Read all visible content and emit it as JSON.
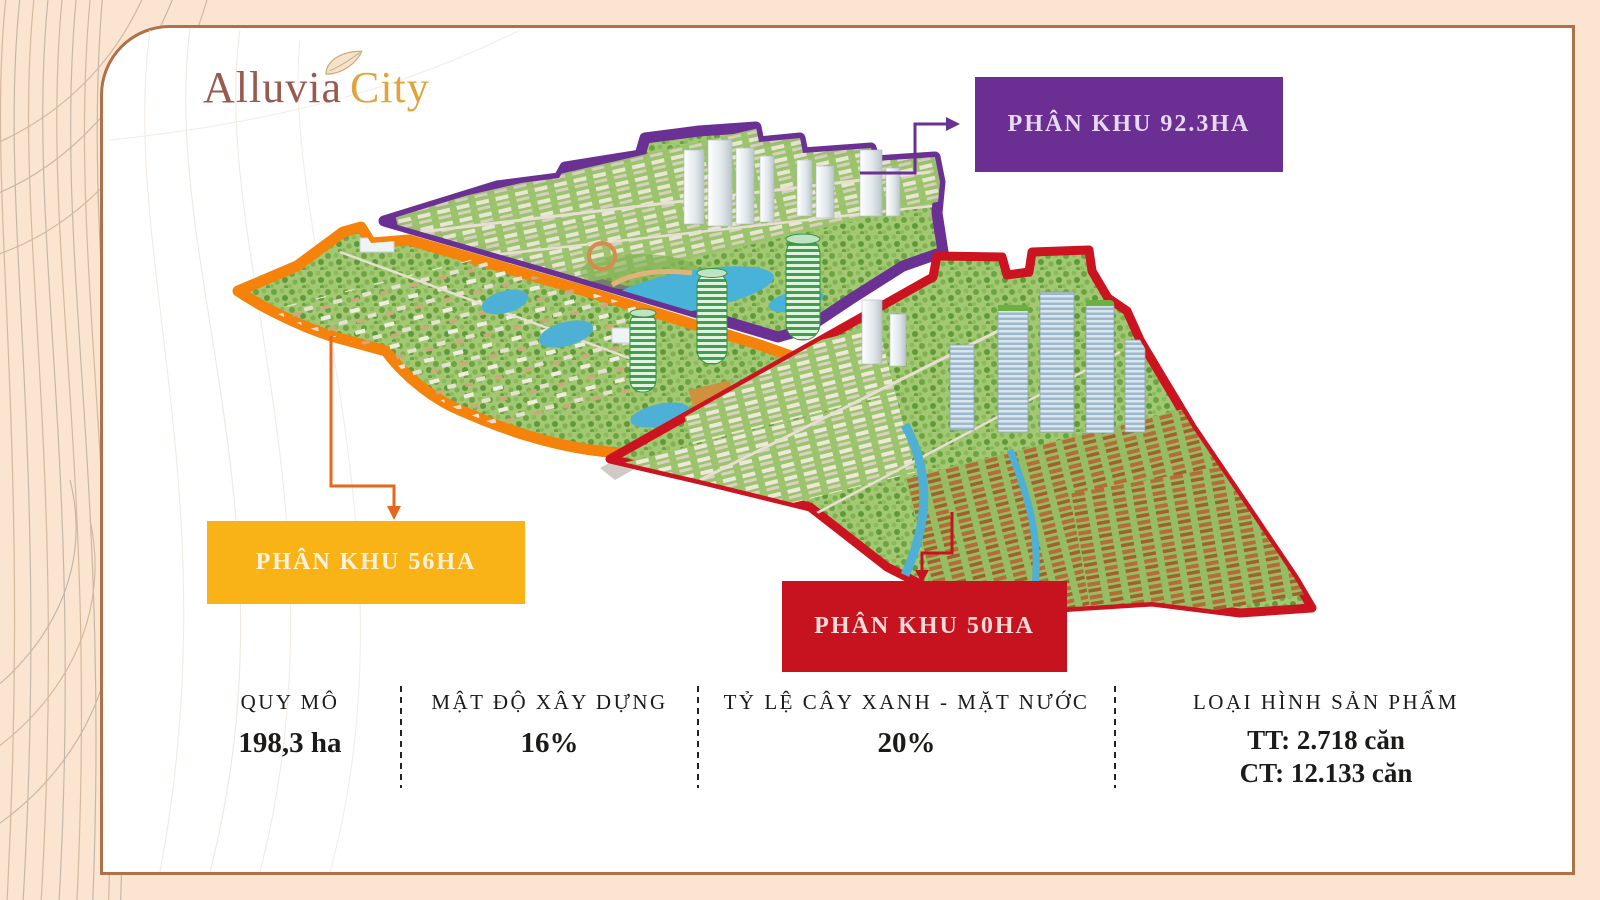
{
  "page": {
    "background_color": "#fbe5d1",
    "panel_border_color": "#b0714a"
  },
  "logo": {
    "name": "Alluvia",
    "suffix": "City",
    "name_color": "#9a594d",
    "suffix_color": "#e0a43e",
    "icon": "leaf-icon"
  },
  "map": {
    "zones": [
      {
        "id": "zone-92ha",
        "outline_color": "#6a3094"
      },
      {
        "id": "zone-56ha",
        "outline_color": "#f5820b"
      },
      {
        "id": "zone-50ha",
        "outline_color": "#cb1420"
      }
    ]
  },
  "callouts": [
    {
      "label": "PHÂN KHU 92.3HA",
      "box_color": "#6b2e92",
      "text_color": "#e6d9f2"
    },
    {
      "label": "PHÂN KHU 56HA",
      "box_color": "#f9b317",
      "text_color": "#fdf3dc"
    },
    {
      "label": "PHÂN KHU 50HA",
      "box_color": "#c6131f",
      "text_color": "#f6dbd9"
    }
  ],
  "stats": [
    {
      "label": "QUY MÔ",
      "values": [
        "198,3 ha"
      ]
    },
    {
      "label": "MẬT ĐỘ XÂY DỰNG",
      "values": [
        "16%"
      ]
    },
    {
      "label": "TỶ LỆ CÂY XANH - MẶT NƯỚC",
      "values": [
        "20%"
      ]
    },
    {
      "label": "LOẠI HÌNH SẢN PHẨM",
      "values": [
        "TT: 2.718 căn",
        "CT: 12.133 căn"
      ]
    }
  ]
}
